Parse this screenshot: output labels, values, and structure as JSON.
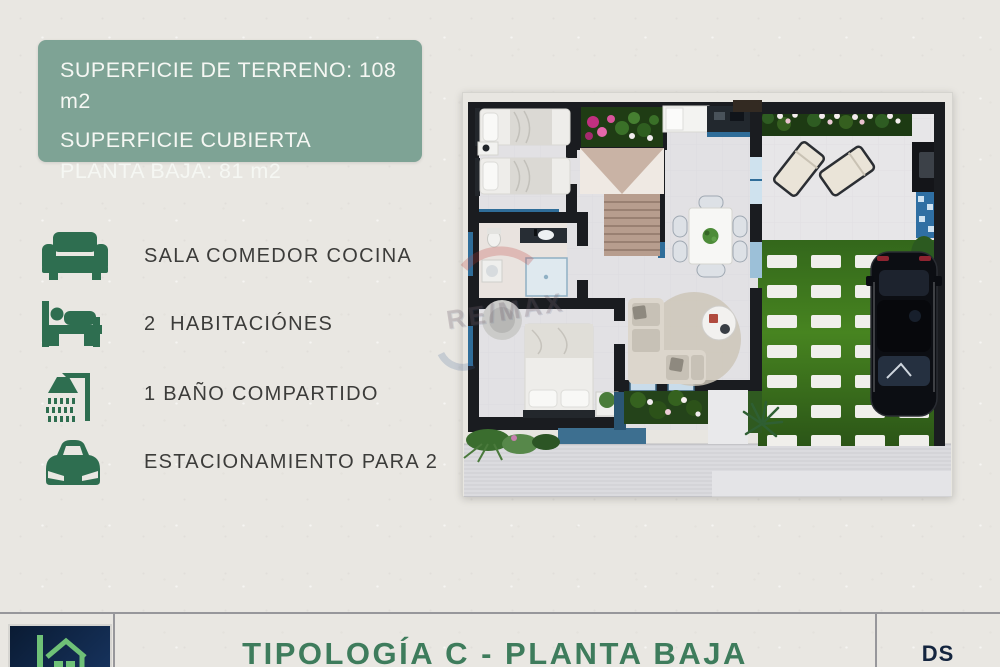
{
  "info_box": {
    "line1": "SUPERFICIE DE TERRENO: 108 m2",
    "line2": "SUPERFICIE CUBIERTA PLANTA BAJA: 81 m2"
  },
  "features": [
    {
      "icon": "sofa-icon",
      "label": "SALA COMEDOR COCINA"
    },
    {
      "icon": "bed-icon",
      "label": "2  HABITACIÓNES"
    },
    {
      "icon": "shower-icon",
      "label": "1 BAÑO COMPARTIDO"
    },
    {
      "icon": "car-icon",
      "label": "ESTACIONAMIENTO PARA 2"
    }
  ],
  "footer": {
    "title": "TIPOLOGÍA C - PLANTA BAJA",
    "initials": "DS"
  },
  "watermark_text": "RE/MAX",
  "colors": {
    "background": "#E9E7E2",
    "info_box_green": "#7EA395",
    "icon_green": "#2E6E50",
    "title_green": "#3E7C5C",
    "logo_navy": "#0E2240",
    "logo_house_green": "#6FC177",
    "divider_gray": "#97979B",
    "plan_wall": "#1A1C20",
    "plan_wall_accent_blue": "#2F6D99",
    "plan_floor": "#E2E1E4",
    "plan_grass": "#3F7B22"
  }
}
